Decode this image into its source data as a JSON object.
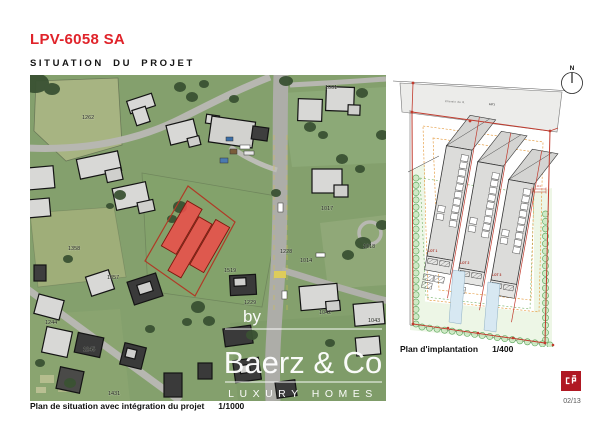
{
  "header": {
    "title": "LPV-6058 SA",
    "subtitle": "SITUATION DU PROJET"
  },
  "situation_map": {
    "caption": "Plan de situation avec intégration du projet",
    "scale": "1/1000",
    "watermark": {
      "prefix": "by",
      "brand": "Baerz & Co",
      "tagline": "LUXURY HOMES"
    },
    "parcels": [
      {
        "label": "1262",
        "x": 52,
        "y": 44
      },
      {
        "label": "1001",
        "x": 295,
        "y": 14
      },
      {
        "label": "1017",
        "x": 291,
        "y": 135
      },
      {
        "label": "1018",
        "x": 333,
        "y": 173
      },
      {
        "label": "1228",
        "x": 250,
        "y": 178
      },
      {
        "label": "1014",
        "x": 270,
        "y": 187
      },
      {
        "label": "1519",
        "x": 194,
        "y": 197
      },
      {
        "label": "1358",
        "x": 38,
        "y": 175
      },
      {
        "label": "1357",
        "x": 77,
        "y": 204
      },
      {
        "label": "1244",
        "x": 15,
        "y": 249
      },
      {
        "label": "1245",
        "x": 53,
        "y": 276
      },
      {
        "label": "1229",
        "x": 214,
        "y": 229
      },
      {
        "label": "1042",
        "x": 289,
        "y": 239
      },
      {
        "label": "1043",
        "x": 338,
        "y": 247
      },
      {
        "label": "1431",
        "x": 78,
        "y": 320
      }
    ]
  },
  "site_plan": {
    "caption": "Plan d'implantation",
    "scale": "1/400",
    "north": "N",
    "road_label": "Chemin de R.",
    "road_ref": "1071",
    "dimension": "40.1",
    "lots": [
      {
        "label": "LOT 1",
        "x": 35,
        "y": 190
      },
      {
        "label": "LOT 2",
        "x": 67,
        "y": 202
      },
      {
        "label": "LOT 3",
        "x": 99,
        "y": 214
      }
    ]
  },
  "footer": {
    "page": "02/13",
    "logo_monogram": "cp"
  },
  "colors": {
    "accent": "#e0232a",
    "logo_red": "#b01823",
    "parcel_red": "#ea4f4a"
  }
}
